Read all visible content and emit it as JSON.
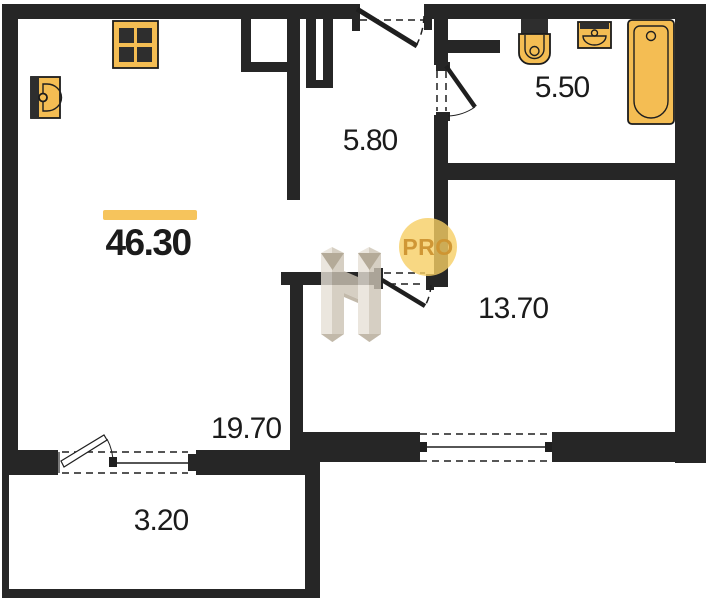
{
  "image_type": "apartment floor plan",
  "plan": {
    "total_area": "46.30",
    "rooms": [
      {
        "name": "living-room",
        "area": "19.70"
      },
      {
        "name": "hallway",
        "area": "5.80"
      },
      {
        "name": "bathroom",
        "area": "5.50"
      },
      {
        "name": "bedroom",
        "area": "13.70"
      },
      {
        "name": "balcony",
        "area": "3.20"
      }
    ],
    "fixtures": [
      {
        "icon": "stove-icon",
        "room": "living-room"
      },
      {
        "icon": "kitchen-sink-icon",
        "room": "living-room"
      },
      {
        "icon": "toilet-icon",
        "room": "bathroom"
      },
      {
        "icon": "sink-icon",
        "room": "bathroom"
      },
      {
        "icon": "bathtub-icon",
        "room": "bathroom"
      }
    ],
    "watermark_label": "PRO",
    "colors": {
      "wall": "#262626",
      "fixture": "#F4BD53",
      "fixture_stroke": "#1b1b1b",
      "fixture_dark": "#2e2e2e",
      "accent_bar": "#F6C45C",
      "label_text": "#1b1b1b",
      "pro_circle": "rgba(246,206,100,0.80)",
      "pro_text": "rgba(206,147,48,0.95)",
      "wm_light": "#E7E1D7",
      "wm_mid": "#CDC4B5",
      "wm_dark": "#B4A896",
      "wm_deep": "#A2967F"
    }
  }
}
